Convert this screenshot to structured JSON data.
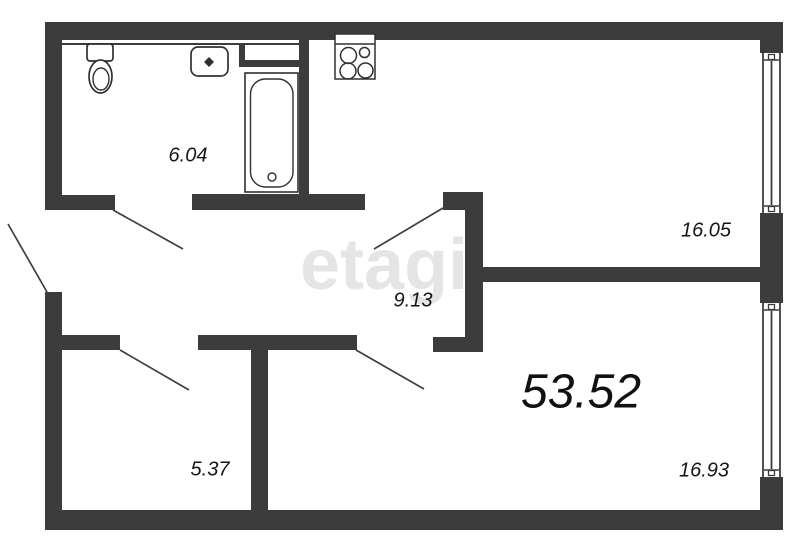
{
  "plan": {
    "type": "apartment-floor-plan",
    "watermark": "etagi",
    "total_area": "53.52",
    "rooms": {
      "bathroom": "6.04",
      "kitchen": "16.05",
      "hallway": "9.13",
      "storage": "5.37",
      "bedroom": "16.93"
    },
    "colors": {
      "wall": "#3c3c3c",
      "background": "#ffffff",
      "label_text": "#161616",
      "watermark_tint": "rgba(150,150,150,0.25)"
    },
    "icons": {
      "stove": "stove-icon",
      "toilet": "toilet-icon",
      "sink": "sink-icon",
      "bathtub": "bathtub-icon",
      "window": "window-icon",
      "door": "door-swing-line"
    }
  }
}
